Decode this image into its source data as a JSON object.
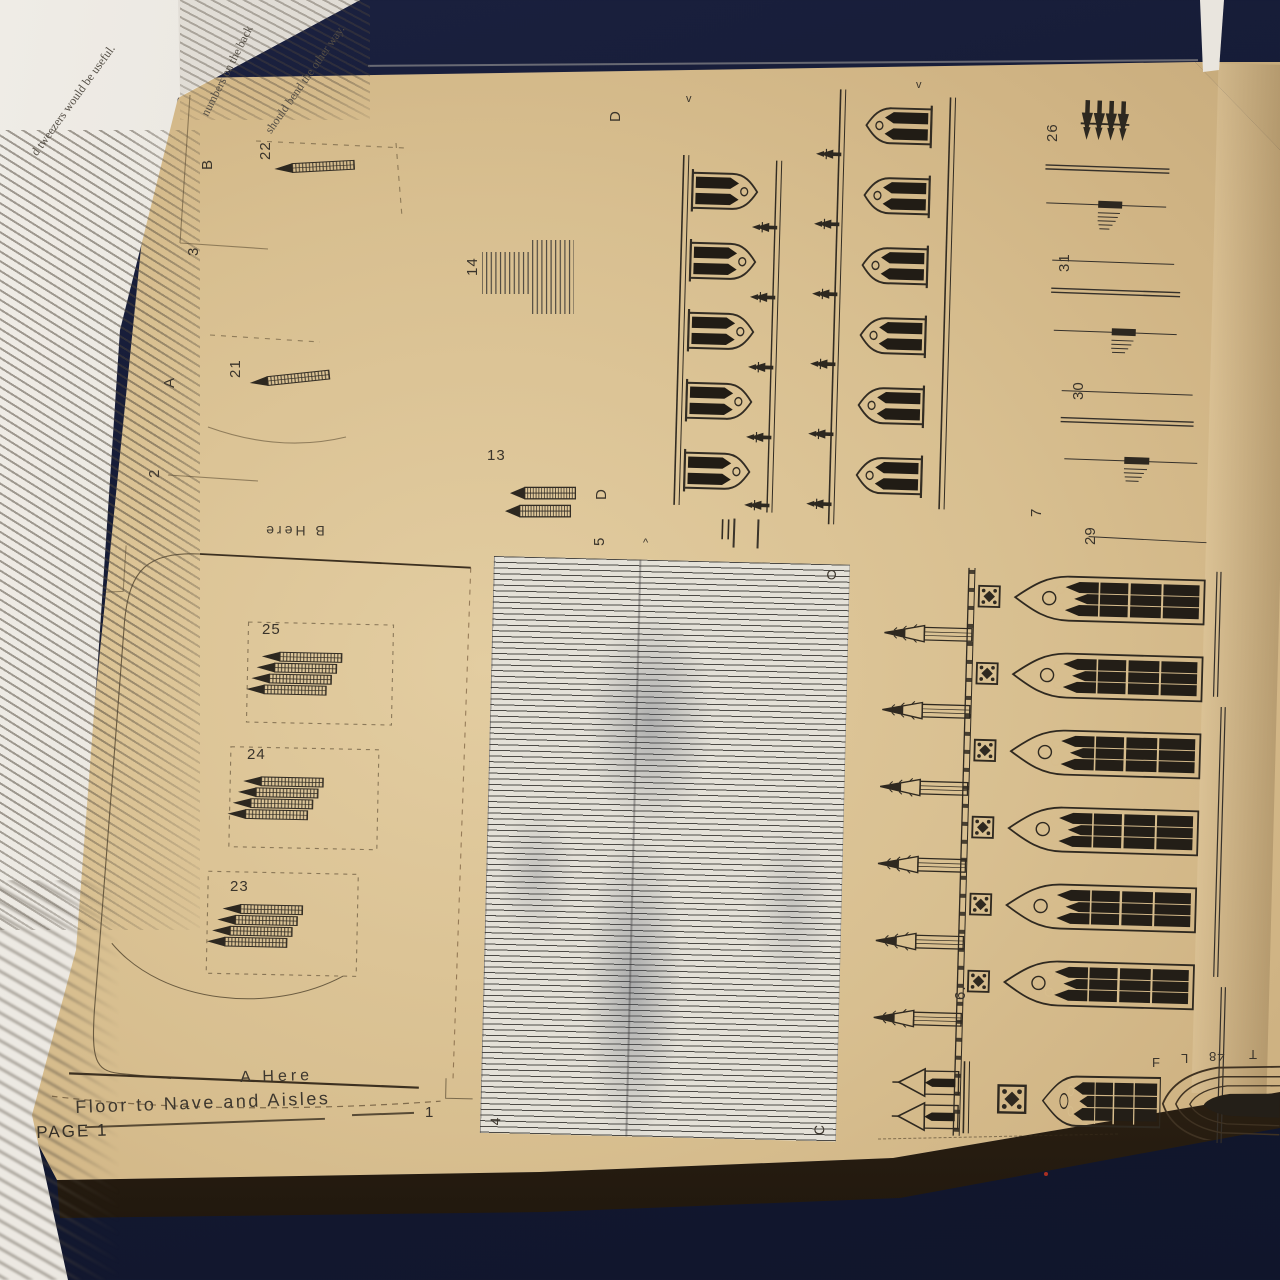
{
  "background": {
    "table_color": "#141a33",
    "page_color": "#d5ba8a",
    "roof_paper_color": "#e4e1d8",
    "ink_color": "#2f2920"
  },
  "instruction_page": {
    "fragment_1": "d tweezers would be useful.",
    "fragment_2": "numbers on the back",
    "fragment_3": "should bend the other way."
  },
  "sheet": {
    "page_label": "PAGE 1",
    "floor": {
      "number": "1",
      "caption": "Floor to Nave and Aisles",
      "glue_a": "A Here",
      "glue_b": "B Here"
    },
    "labels": {
      "l2": "2",
      "l3": "3",
      "l4": "4",
      "l5": "5",
      "l6": "6.",
      "l7": "7",
      "l13": "13",
      "l14": "14",
      "l21": "21",
      "l22": "22",
      "l23": "23",
      "l24": "24",
      "l25": "25",
      "l26": "26",
      "l29": "29",
      "l30": "30",
      "l31": "31",
      "la": "A",
      "lb": "B",
      "lc": "C",
      "ld_top": "D",
      "ld_mid": "D",
      "lo": "O",
      "portal_f": "F",
      "portal_l": "L",
      "portal_48": "48",
      "portal_t": "T",
      "arrow_down": "v",
      "arrow_up": "^"
    }
  }
}
